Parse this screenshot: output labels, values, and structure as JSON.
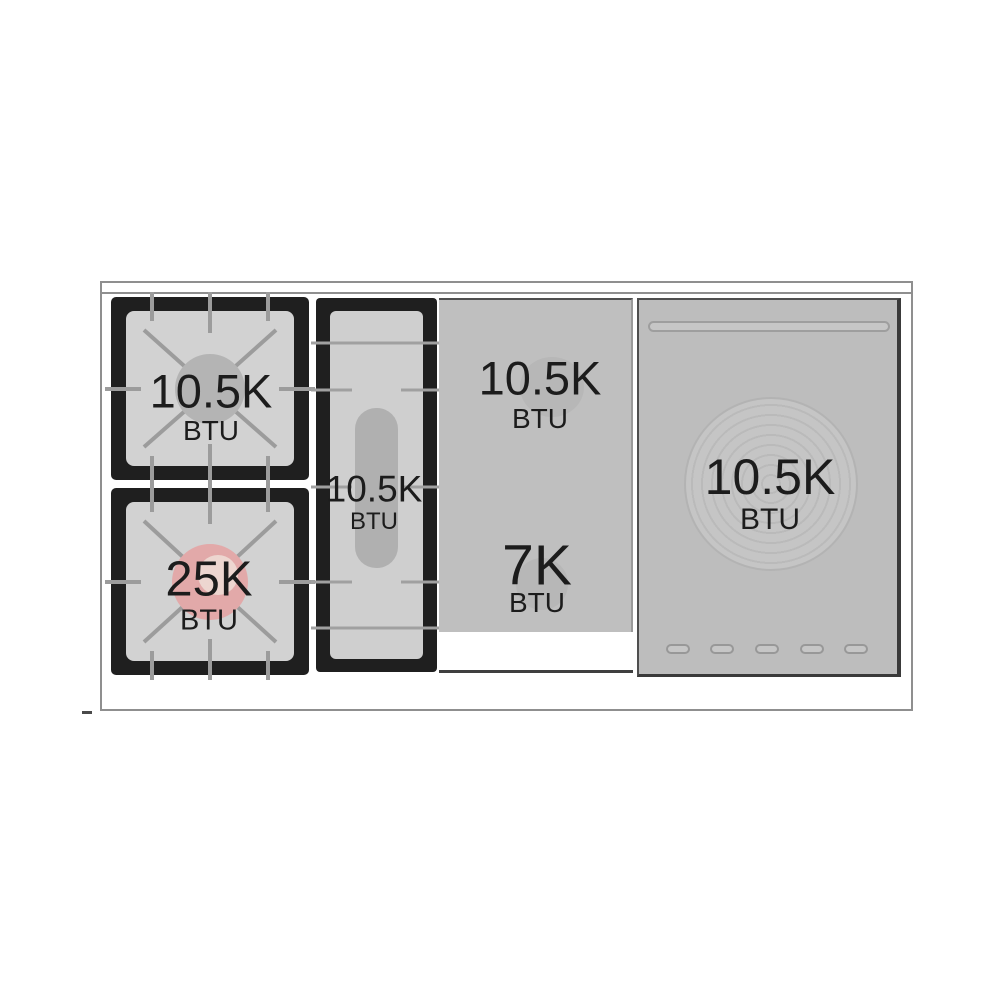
{
  "diagram": {
    "type": "range-cooktop-btu-diagram",
    "burners": {
      "left_rear": {
        "value": "10.5K",
        "unit": "BTU"
      },
      "left_front": {
        "value": "25K",
        "unit": "BTU"
      },
      "center_griddle": {
        "value": "10.5K",
        "unit": "BTU"
      },
      "right_rear": {
        "value": "10.5K",
        "unit": "BTU"
      },
      "right_front": {
        "value": "7K",
        "unit": "BTU"
      },
      "far_right": {
        "value": "10.5K",
        "unit": "BTU"
      }
    },
    "colors": {
      "frame_black": "#1f1f1f",
      "grate_surface": "#d2d2d2",
      "grate_line": "#9c9c9c",
      "panel_gray": "#bfbfbf",
      "burner_cap_gray": "#b4b4b4",
      "power_burner_highlight": "#e2a9a9",
      "outline_gray": "#8f8f8f",
      "text": "#1c1c1c"
    }
  }
}
